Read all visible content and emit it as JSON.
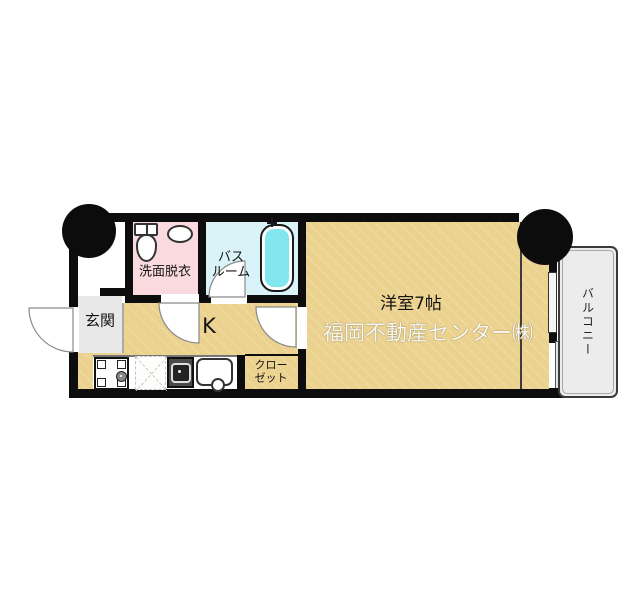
{
  "colors": {
    "wall": "#0d0d0d",
    "floor_tan": "#ecd28f",
    "washroom_pink": "#fadade",
    "bathroom_cyan": "#daf3f8",
    "bathtub_cyan": "#82e6ef",
    "entrance_gray": "#e8e8e8",
    "balcony_gray": "#ececec"
  },
  "floorplan": {
    "rooms": {
      "washroom": {
        "label": "洗面脱衣"
      },
      "bathroom": {
        "label_line1": "バス",
        "label_line2": "ルーム"
      },
      "entrance": {
        "label": "玄関"
      },
      "kitchen": {
        "label": "K"
      },
      "closet": {
        "label_line1": "クロー",
        "label_line2": "ゼット"
      },
      "main_room": {
        "label": "洋室7帖"
      },
      "balcony": {
        "label": "バルコニー"
      }
    },
    "watermark": "福岡不動産センター㈱",
    "fixtures": {
      "toilet": "toilet-icon",
      "washbasin": "washbasin-icon",
      "bathtub": "bathtub-icon",
      "washing_machine": "washing-machine-icon",
      "refrigerator_space": "refrigerator-space-icon",
      "stove": "gas-stove-icon",
      "kitchen_sink": "kitchen-sink-icon",
      "sliding_window": "sliding-window-icon",
      "door_swing": "door-swing-arc-icon",
      "corner_pillar": "pillar-icon"
    }
  }
}
